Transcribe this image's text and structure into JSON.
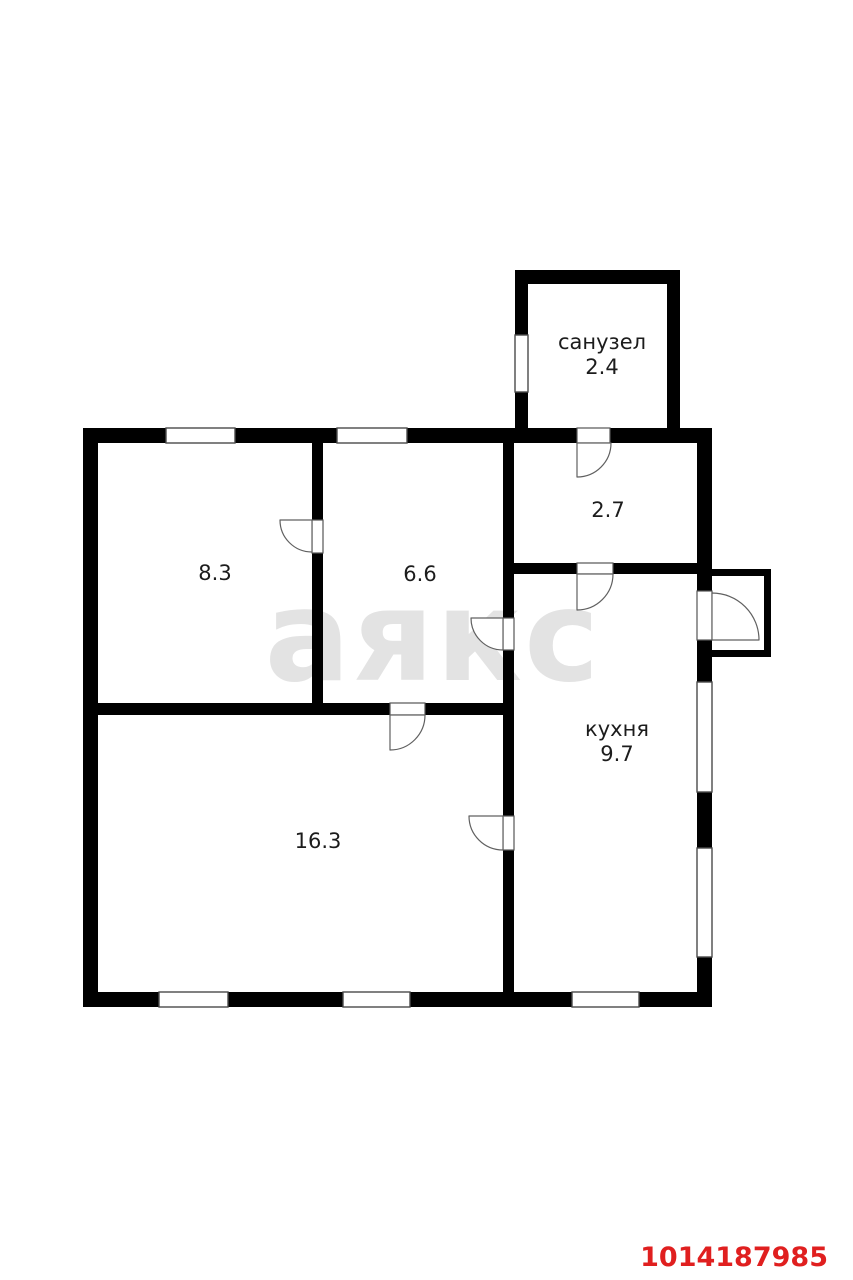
{
  "watermark": {
    "text": "аякс",
    "color": "#e3e3e3"
  },
  "listing_id": {
    "value": "1014187985",
    "color": "#e01f1f"
  },
  "rooms": {
    "sanuzel": {
      "label": "санузел",
      "area": "2.4"
    },
    "hallway": {
      "area": "2.7"
    },
    "room_8_3": {
      "area": "8.3"
    },
    "room_6_6": {
      "area": "6.6"
    },
    "kitchen": {
      "label": "кухня",
      "area": "9.7"
    },
    "room_16_3": {
      "area": "16.3"
    }
  },
  "colors": {
    "wall": "#000000",
    "room_fill": "#ffffff",
    "label_text": "#1c1c1c"
  }
}
